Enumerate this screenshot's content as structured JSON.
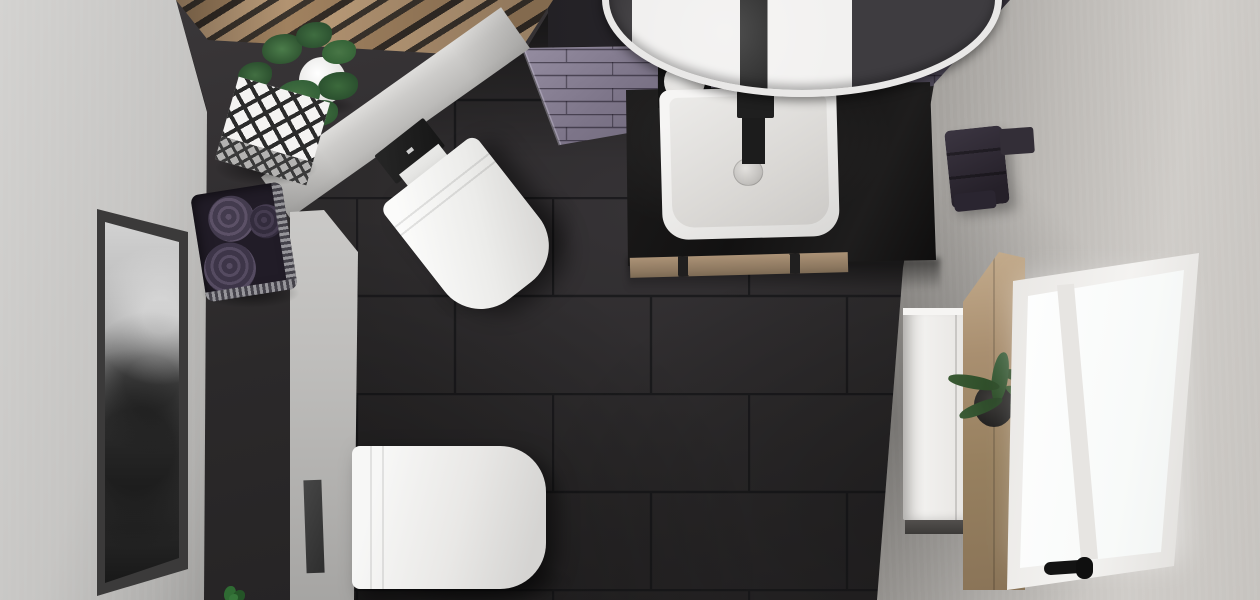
{
  "scene": {
    "type": "3d-interior-render",
    "view": "top-down-perspective",
    "room": "bathroom"
  },
  "palette": {
    "floor-tile": "#2c2a2b",
    "grout": "#18171a",
    "niche-wall": "#2e2c2d",
    "left-wall": "#c6c5c3",
    "right-wall": "#bdbab6",
    "lilac-tile": "#7d7589",
    "lilac-tile-dark": "#443f4e",
    "ceiling-dark": "#232125",
    "wood-slat": "#a8875f",
    "wood-trim": "#9b8468",
    "countertop-black": "#141313",
    "ceramic-white": "#f2f1f0",
    "fixture-black": "#1c1c1c",
    "towel-purple": "#4e4458",
    "plant-green": "#2f5431",
    "window-glow": "#ffffff",
    "cabinet-white": "#efeeec",
    "shelf-wood": "#a98f70",
    "frame-dark": "#3b3a3a"
  },
  "objects": {
    "round-mirror": "round wall mirror reflecting washbasin",
    "washbasin": "white square countertop basin",
    "faucet": "black wall faucet",
    "soap-dispenser": "white soap dispenser on black tray",
    "vanity": "black stone vanity countertop with wood trim",
    "toilet-corner": "wall-hung toilet on angled wall with black flush plate",
    "toilet-left": "wall-hung toilet on left wall with black flush plate",
    "lilac-wall": "lilac brick tile accent wall",
    "wood-ceiling": "wood slat ceiling detail",
    "plant-corner": "potted plant in white pot",
    "decor-box": "black and white diamond pattern box",
    "towel-basket": "wire basket with purple rolled towels",
    "picture": "black and white framed artwork",
    "window": "white frame window with black handle",
    "cabinet": "tall white cabinet",
    "shelf": "wooden shelf panel with potted aloe",
    "towel-radiator": "dark towels on wall rack",
    "floor": "large dark slate floor tiles"
  }
}
